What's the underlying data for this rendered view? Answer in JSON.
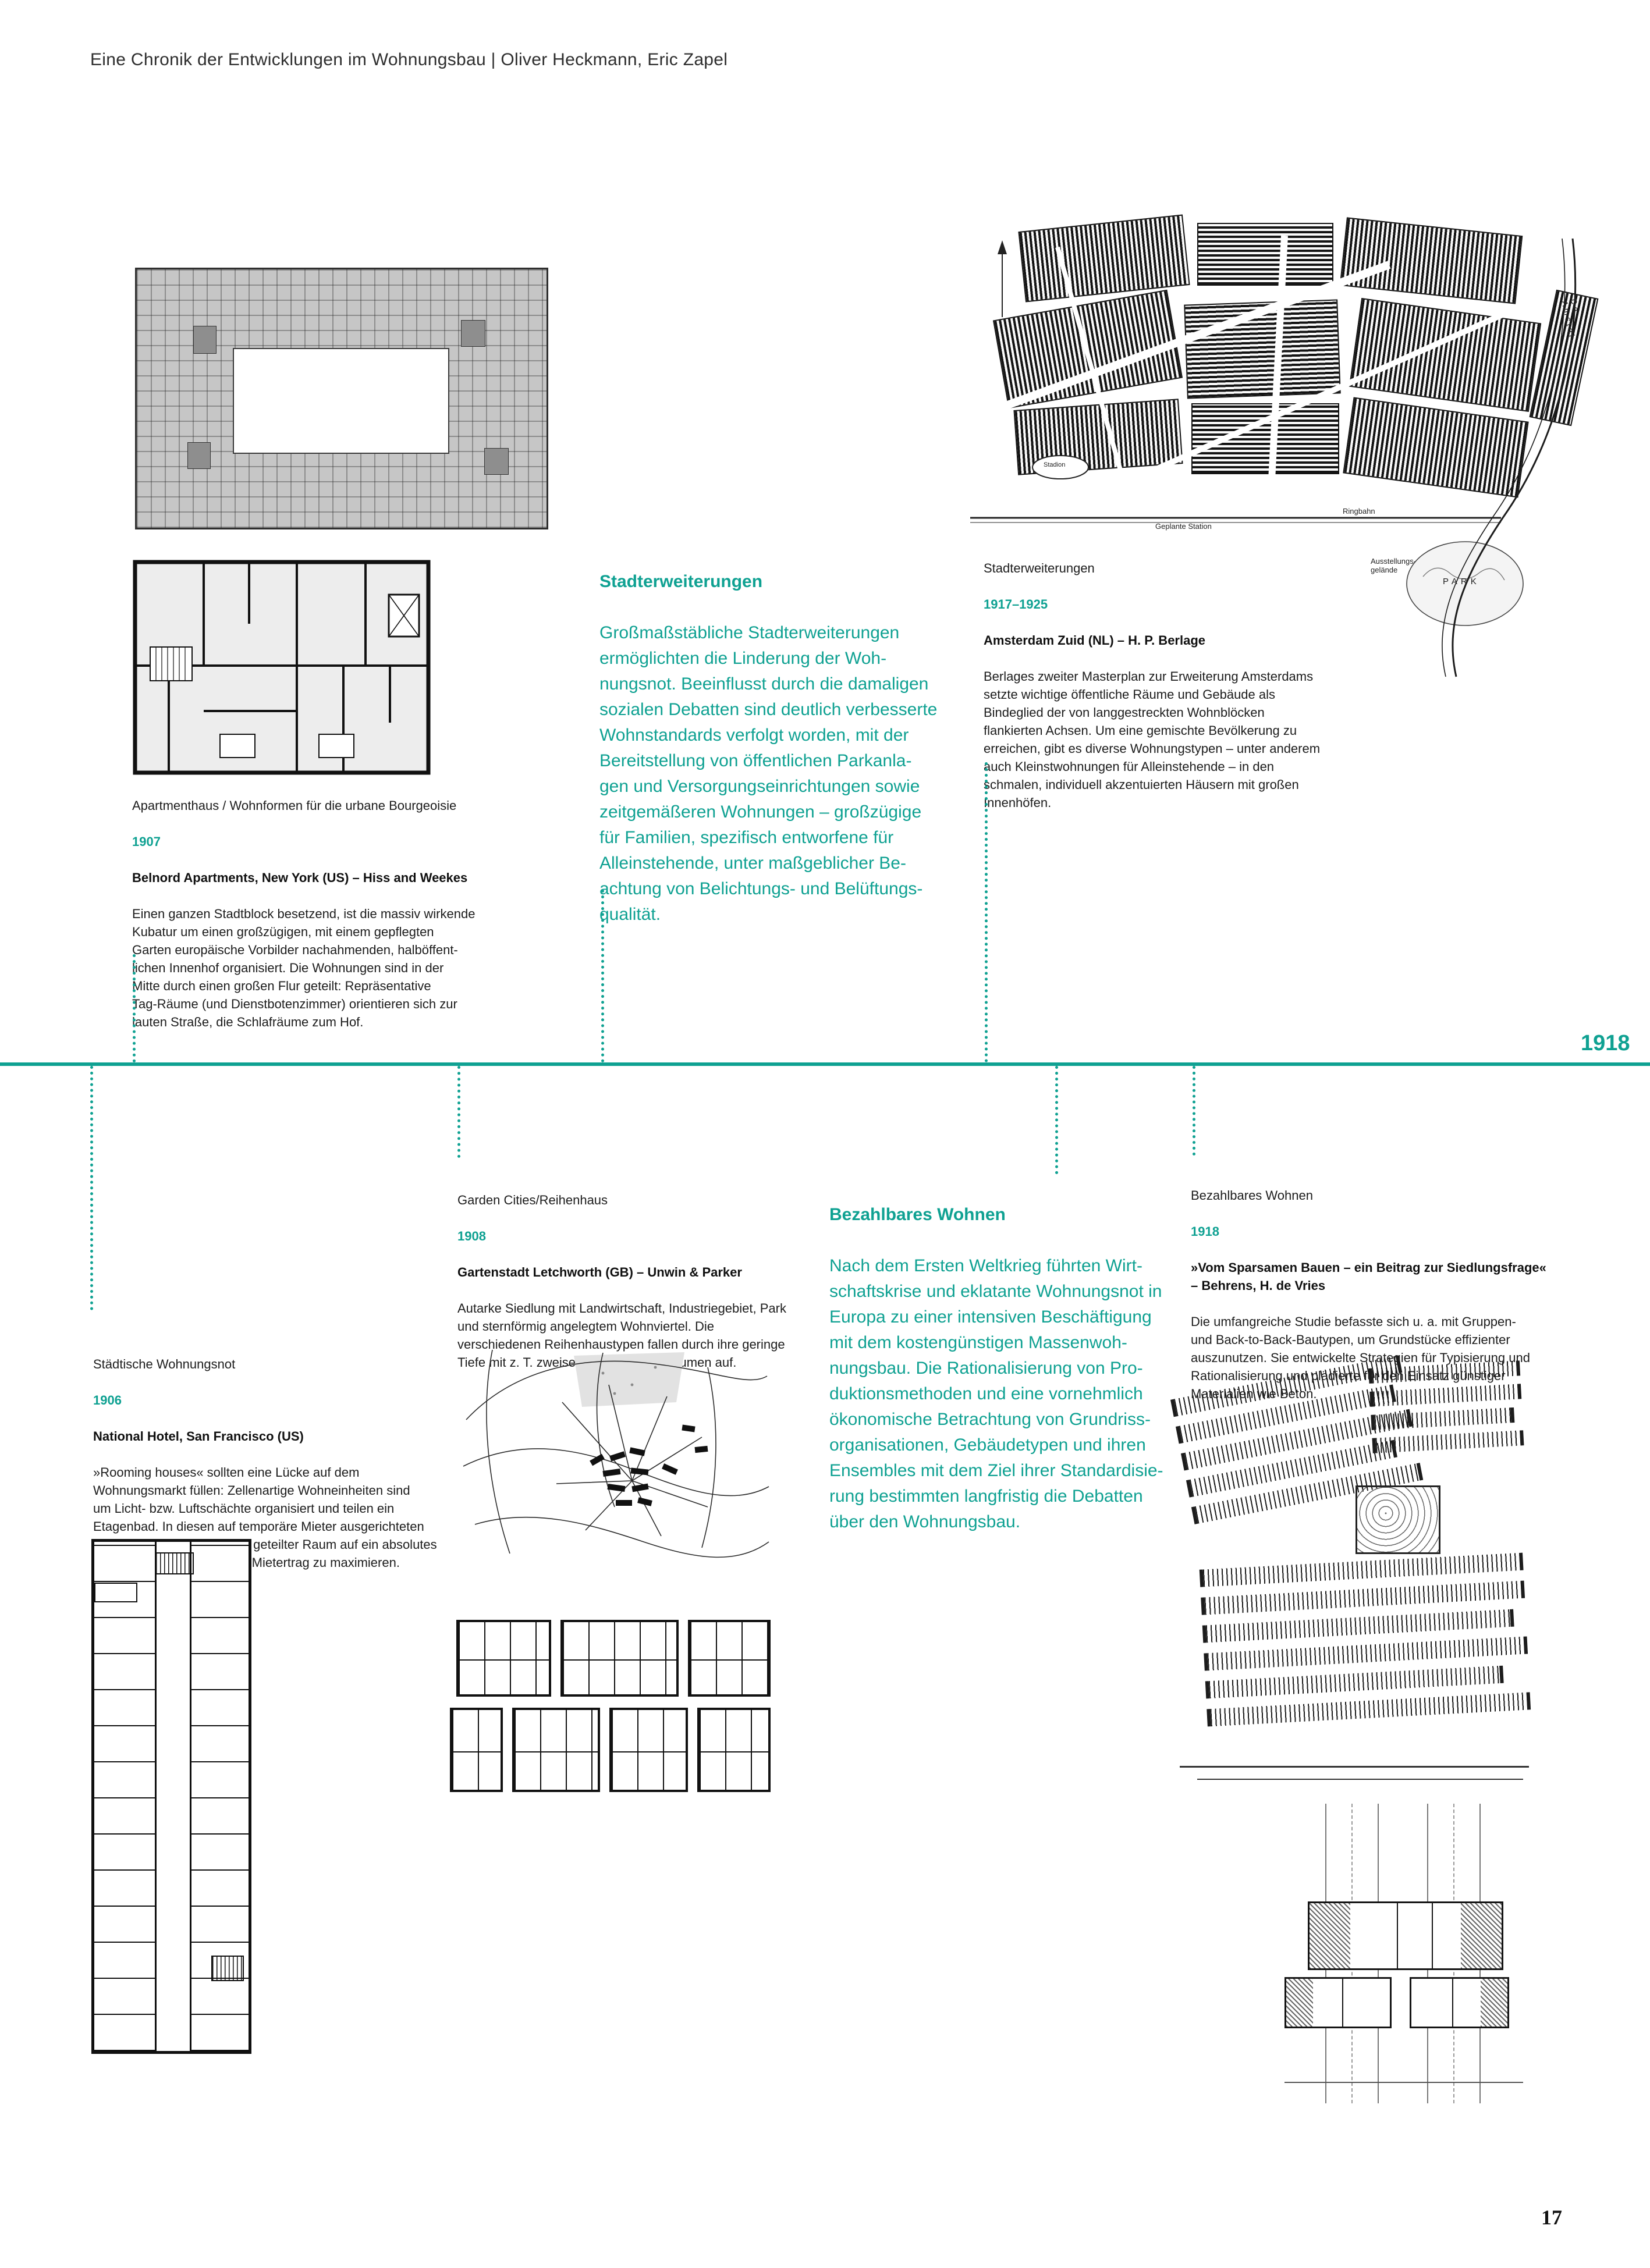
{
  "page": {
    "header": "Eine Chronik der Entwicklungen im Wohnungsbau | Oliver Heckmann, Eric Zapel",
    "year_marker": "1918",
    "page_number": "17",
    "accent_color": "#0fa192"
  },
  "sections": {
    "stadterweiterungen_intro": {
      "heading": "Stadterweiterungen",
      "body": "Großmaßstäbliche Stadterweiterungen\nermöglichten die Linderung der Woh-\nnungsnot. Beeinflusst durch die damaligen\nsozialen Debatten sind deutlich verbesserte\nWohnstandards verfolgt worden, mit der\nBereitstellung von öffentlichen Parkanla-\ngen und Versorgungseinrichtungen sowie\nzeitgemäßeren Wohnungen – großzügige\nfür Familien, spezifisch entworfene für\nAlleinstehende, unter maßgeblicher Be-\nachtung von Belichtungs- und Belüftungs-\nqualität."
    },
    "amsterdam": {
      "category": "Stadterweiterungen",
      "years": "1917–1925",
      "title": "Amsterdam Zuid (NL) – H. P. Berlage",
      "body": "Berlages zweiter Masterplan zur Erweiterung Amsterdams\nsetzte wichtige öffentliche Räume und Gebäude als\nBindeglied der von langgestreckten Wohnblöcken\nflankierten Achsen. Um eine gemischte Bevölkerung zu\nerreichen, gibt es diverse Wohnungstypen – unter anderem\nauch Kleinstwohnungen für Alleinstehende – in den\nschmalen, individuell akzentuierten Häusern mit großen\nInnenhöfen."
    },
    "belnord": {
      "category": "Apartmenthaus / Wohnformen für die urbane Bourgeoisie",
      "year": "1907",
      "title": "Belnord Apartments, New York (US) – Hiss and Weekes",
      "body": "Einen ganzen Stadtblock besetzend, ist die massiv wirkende\nKubatur um einen großzügigen, mit einem gepflegten\nGarten europäische Vorbilder nachahmenden, halböffent-\nlichen Innenhof organisiert. Die Wohnungen sind in der\nMitte durch einen großen Flur geteilt: Repräsentative\nTag-Räume (und Dienstbotenzimmer) orientieren sich zur\nlauten Straße, die Schlafräume zum Hof."
    },
    "national_hotel": {
      "category": "Städtische Wohnungsnot",
      "year": "1906",
      "title": "National Hotel, San Francisco (US)",
      "body": "»Rooming houses« sollten eine Lücke auf dem\nWohnungsmarkt füllen: Zellenartige Wohneinheiten sind\num Licht- bzw. Luftschächte organisiert und teilen ein\nEtagenbad. In diesen auf temporäre Mieter ausgerichteten\nHäusern wurde gemeinsam geteilter Raum auf ein absolutes\nMinimum reduziert, um den Mietertrag zu maximieren."
    },
    "letchworth": {
      "category": "Garden Cities/Reihenhaus",
      "year": "1908",
      "title": "Gartenstadt Letchworth (GB) – Unwin & Parker",
      "body": "Autarke Siedlung mit Landwirtschaft, Industriegebiet, Park\nund sternförmig angelegtem Wohnviertel. Die\nverschiedenen Reihenhaustypen fallen durch ihre geringe\nTiefe mit z. T. zweiseitig orientierten Räumen auf."
    },
    "bezahlbares_intro": {
      "heading": "Bezahlbares Wohnen",
      "body": "Nach dem Ersten Weltkrieg führten Wirt-\nschaftskrise und eklatante Wohnungsnot in\nEuropa zu einer intensiven Beschäftigung\nmit dem kostengünstigen Massenwoh-\nnungsbau. Die Rationalisierung von Pro-\nduktionsmethoden und eine vornehmlich\nökonomische Betrachtung von Grundriss-\norganisationen, Gebäudetypen und ihren\nEnsembles mit dem Ziel ihrer Standardisie-\nrung bestimmten langfristig die Debatten\nüber den Wohnungsbau."
    },
    "sparsames_bauen": {
      "category": "Bezahlbares Wohnen",
      "year": "1918",
      "title": "»Vom Sparsamen Bauen – ein Beitrag zur Siedlungsfrage«\n– Behrens, H. de Vries",
      "body": "Die umfangreiche Studie befasste sich u. a. mit Gruppen-\nund Back-to-Back-Bautypen, um Grundstücke effizienter\nauszunutzen. Sie entwickelte Strategien für Typisierung und\nRationalisierung und plädierte für den Einsatz günstiger\nMaterialien wie Beton."
    }
  },
  "map_labels": {
    "amsterdam": {
      "ringbahn": "Ringbahn",
      "geplante_station": "Geplante Station",
      "ausstellung": "Ausstellungs-\ngelände",
      "park": "PARK",
      "stadion": "Stadion",
      "river": "De Amstel"
    }
  }
}
